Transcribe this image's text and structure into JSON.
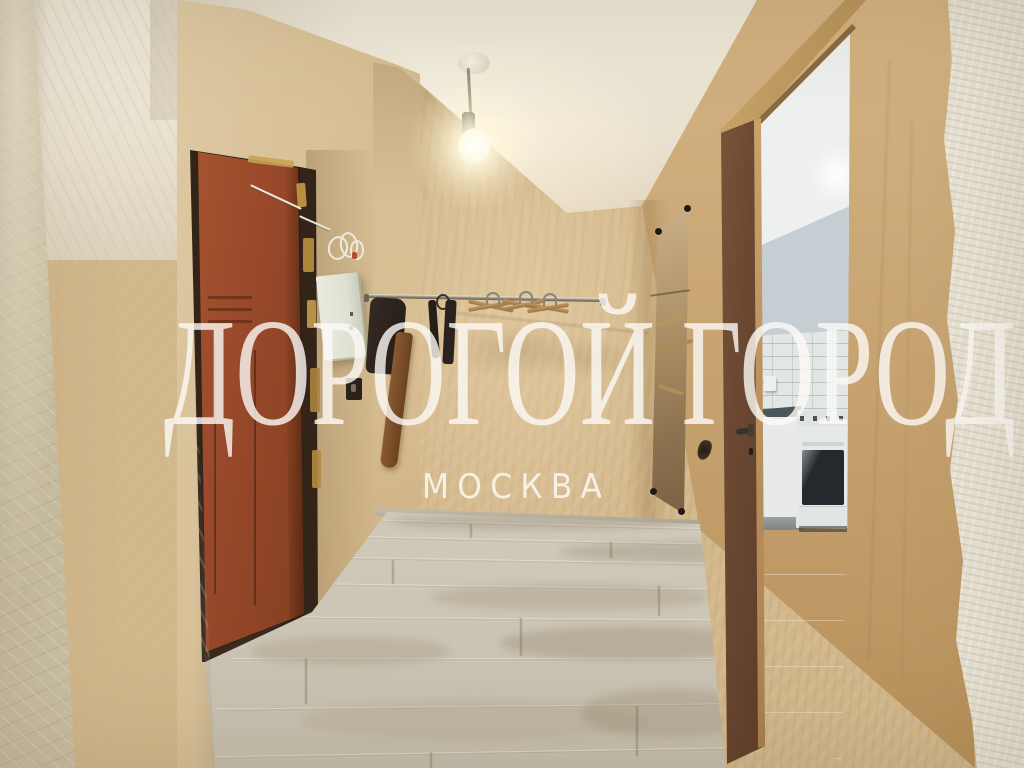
{
  "watermark": {
    "title": "ДОРОГОЙ ГОРОД",
    "subtitle": "МОСКВА"
  },
  "colors": {
    "watermark_text": "rgba(252,250,246,0.8)",
    "hall_wall_beige": "#d2b78b",
    "right_wall_tan": "#c6a476",
    "foreground_wall_cream": "#e8e3d5",
    "left_wallpaper": "#cabfa3",
    "partition_wall_grey": "#e3e0d4",
    "ceiling": "#eae2d0",
    "entrance_door_red_brown": "#9a4a2b",
    "kitchen_door_walnut": "#6b4832",
    "door_casing_oak": "#c09a62",
    "laminate_floor": "#c6bfb0",
    "kitchen_wall_blue_grey": "#c4ced3",
    "kitchen_floor_grey": "#b6bdb9",
    "oven_glass": "#24292d"
  },
  "scene": {
    "objects": [
      "ceiling-light-bulb",
      "entrance-door",
      "electrical-box",
      "coat-rail-with-hangers",
      "wall-mirror",
      "kitchen-doorway",
      "gas-stove",
      "laminate-floor"
    ]
  }
}
